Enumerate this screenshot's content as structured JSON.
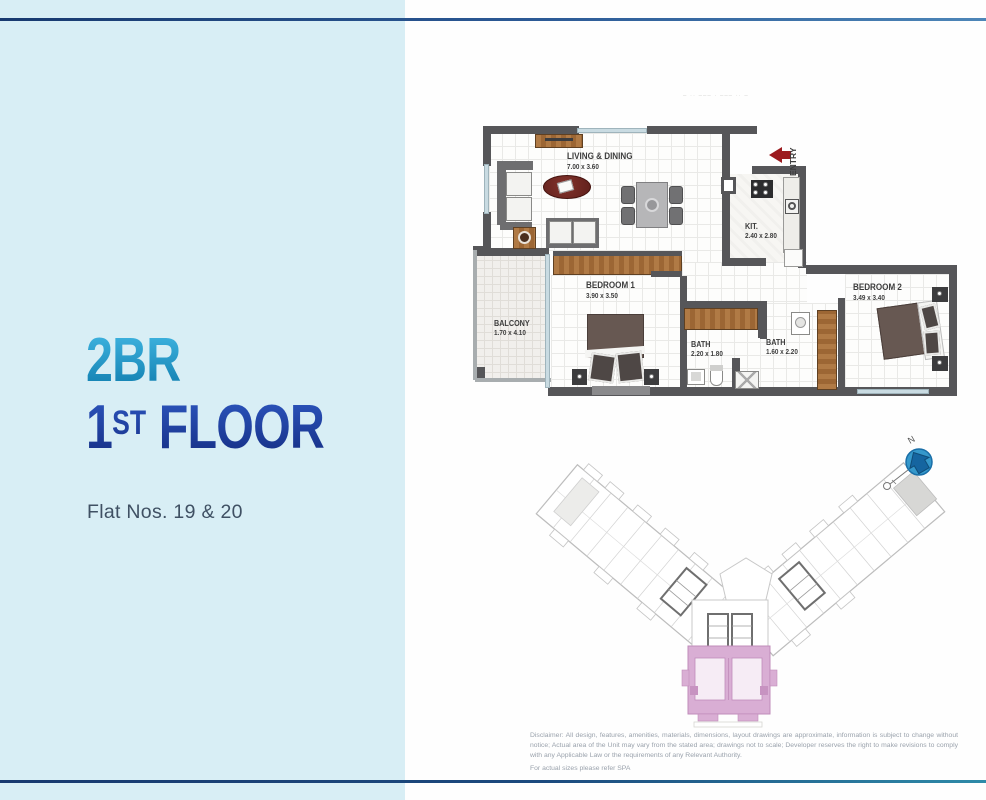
{
  "left_panel": {
    "unit_type": "2BR",
    "floor_line": {
      "num": "1",
      "sup": "ST",
      "word": " FLOOR"
    },
    "flat_nos": "Flat Nos. 19 & 20"
  },
  "floorplan": {
    "living": {
      "name": "LIVING & DINING",
      "dims": "7.00 x 3.60"
    },
    "kitchen": {
      "name": "KIT.",
      "dims": "2.40 x 2.80"
    },
    "bedroom1": {
      "name": "BEDROOM 1",
      "dims": "3.90 x 3.50"
    },
    "bedroom2": {
      "name": "BEDROOM 2",
      "dims": "3.49 x 3.40"
    },
    "bath1": {
      "name": "BATH",
      "dims": "2.20 x 1.80"
    },
    "bath2": {
      "name": "BATH",
      "dims": "1.60 x 2.20"
    },
    "balcony": {
      "name": "BALCONY",
      "dims": "1.70 x 4.10"
    },
    "entry_label": "ENTRY",
    "faded_note": "– ·· ––– · ––– ·· –"
  },
  "keyplan": {
    "north_label": "N"
  },
  "disclaimer": {
    "line1": "Disclaimer: All design, features, amenities, materials, dimensions, layout drawings are approximate, information is subject to change without notice; Actual area of the Unit may vary from the stated area; drawings not to scale; Developer reserves the right to make revisions to comply with any Applicable Law or the requirements of any Relevant Authority.",
    "line2": "For actual sizes please refer SPA"
  },
  "colors": {
    "panel_bg": "#d8eef5",
    "headline_cyan": "#1f93c0",
    "headline_navy": "#2547ab",
    "wall": "#565659",
    "wood": "#a9713e",
    "entry_red": "#9c1b1f",
    "keyplan_pink": "#d9aed4",
    "compass_blue": "#2e93c6"
  }
}
